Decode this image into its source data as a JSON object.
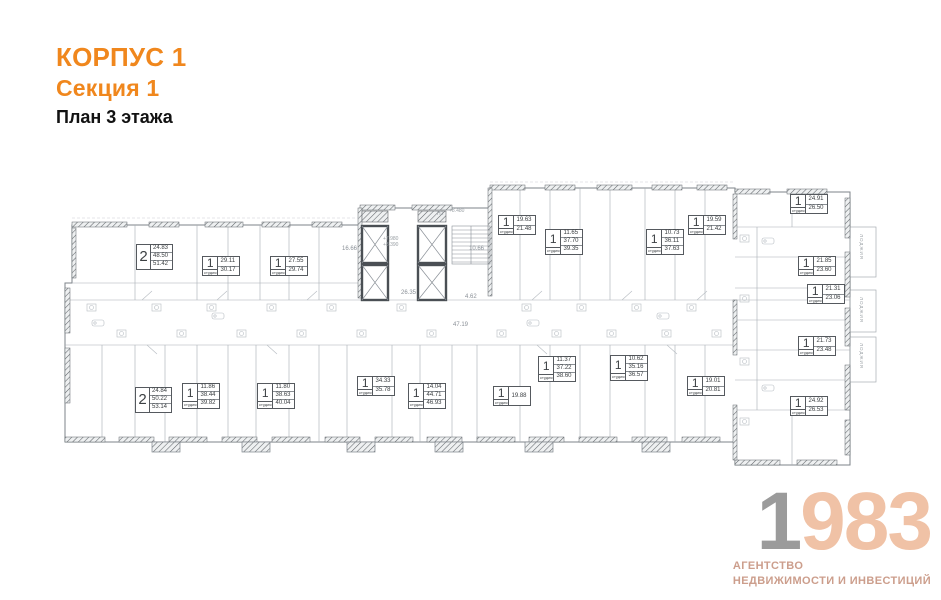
{
  "header": {
    "building": "КОРПУС 1",
    "section": "Секция 1",
    "floor": "План 3 этажа",
    "accent_color": "#f0871d"
  },
  "logo": {
    "year_gray": "1",
    "year_peach": "983",
    "caption_line1": "АГЕНТСТВО",
    "caption_line2": "НЕДВИЖИМОСТИ И ИНВЕСТИЦИЙ",
    "gray_color": "#9b9b9b",
    "peach_color": "#f0c2a6",
    "caption_color": "#cc9e8c"
  },
  "plan": {
    "apartments": [
      {
        "type": "2",
        "sub": "",
        "areas": [
          "24.83",
          "48.50",
          "51.42"
        ],
        "x": 79,
        "y": 64
      },
      {
        "type": "1",
        "sub": "студия",
        "areas": [
          "29.11",
          "30.17"
        ],
        "x": 145,
        "y": 76
      },
      {
        "type": "1",
        "sub": "студия",
        "areas": [
          "27.55",
          "29.74"
        ],
        "x": 213,
        "y": 76
      },
      {
        "type": "1",
        "sub": "студия",
        "areas": [
          "19.63",
          "21.48"
        ],
        "x": 441,
        "y": 35
      },
      {
        "type": "1",
        "sub": "студия",
        "areas": [
          "11.65",
          "37.70",
          "39.35"
        ],
        "x": 488,
        "y": 49
      },
      {
        "type": "1",
        "sub": "студия",
        "areas": [
          "10.73",
          "36.11",
          "37.63"
        ],
        "x": 589,
        "y": 49
      },
      {
        "type": "1",
        "sub": "студия",
        "areas": [
          "19.59",
          "21.42"
        ],
        "x": 631,
        "y": 35
      },
      {
        "type": "1",
        "sub": "студия",
        "areas": [
          "24.91",
          "26.50"
        ],
        "x": 733,
        "y": 14
      },
      {
        "type": "1",
        "sub": "студия",
        "areas": [
          "21.85",
          "23.60"
        ],
        "x": 741,
        "y": 76
      },
      {
        "type": "1",
        "sub": "студия",
        "areas": [
          "21.31",
          "23.06"
        ],
        "x": 750,
        "y": 104
      },
      {
        "type": "1",
        "sub": "студия",
        "areas": [
          "21.73",
          "23.48"
        ],
        "x": 741,
        "y": 156
      },
      {
        "type": "1",
        "sub": "студия",
        "areas": [
          "24.92",
          "26.53"
        ],
        "x": 733,
        "y": 216
      },
      {
        "type": "2",
        "sub": "",
        "areas": [
          "24.84",
          "50.22",
          "53.14"
        ],
        "x": 78,
        "y": 207
      },
      {
        "type": "1",
        "sub": "студия",
        "areas": [
          "11.86",
          "38.44",
          "39.82"
        ],
        "x": 125,
        "y": 203
      },
      {
        "type": "1",
        "sub": "студия",
        "areas": [
          "11.80",
          "38.63",
          "40.04"
        ],
        "x": 200,
        "y": 203
      },
      {
        "type": "1",
        "sub": "студия",
        "areas": [
          "34.33",
          "35.78"
        ],
        "x": 300,
        "y": 196
      },
      {
        "type": "1",
        "sub": "студия",
        "areas": [
          "14.04",
          "44.71",
          "46.93"
        ],
        "x": 351,
        "y": 203
      },
      {
        "type": "1",
        "sub": "студия",
        "areas": [
          "19.88"
        ],
        "x": 436,
        "y": 206
      },
      {
        "type": "1",
        "sub": "студия",
        "areas": [
          "11.37",
          "37.22",
          "38.60"
        ],
        "x": 481,
        "y": 176
      },
      {
        "type": "1",
        "sub": "студия",
        "areas": [
          "10.62",
          "35.16",
          "36.57"
        ],
        "x": 553,
        "y": 175
      },
      {
        "type": "1",
        "sub": "студия",
        "areas": [
          "19.01",
          "20.81"
        ],
        "x": 630,
        "y": 196
      }
    ],
    "annotations": [
      {
        "text": "16.66",
        "x": 285,
        "y": 66,
        "style": "area"
      },
      {
        "text": "10.66",
        "x": 412,
        "y": 66,
        "style": "area"
      },
      {
        "text": "26.35",
        "x": 344,
        "y": 110,
        "style": "area"
      },
      {
        "text": "4.62",
        "x": 408,
        "y": 114,
        "style": "area"
      },
      {
        "text": "47.19",
        "x": 396,
        "y": 142,
        "style": "area"
      },
      {
        "text": "+8.480",
        "x": 392,
        "y": 28,
        "style": "elev"
      },
      {
        "text": "Н2",
        "x": 380,
        "y": 31,
        "style": "elev"
      },
      {
        "text": "+7.980",
        "x": 326,
        "y": 56,
        "style": "elev"
      },
      {
        "text": "+8.390",
        "x": 326,
        "y": 62,
        "style": "elev"
      },
      {
        "text": "ЛОДЖИЯ",
        "x": 802,
        "y": 54,
        "style": "vert"
      },
      {
        "text": "ЛОДЖИЯ",
        "x": 802,
        "y": 117,
        "style": "vert"
      },
      {
        "text": "ЛОДЖИЯ",
        "x": 802,
        "y": 163,
        "style": "vert"
      }
    ]
  }
}
